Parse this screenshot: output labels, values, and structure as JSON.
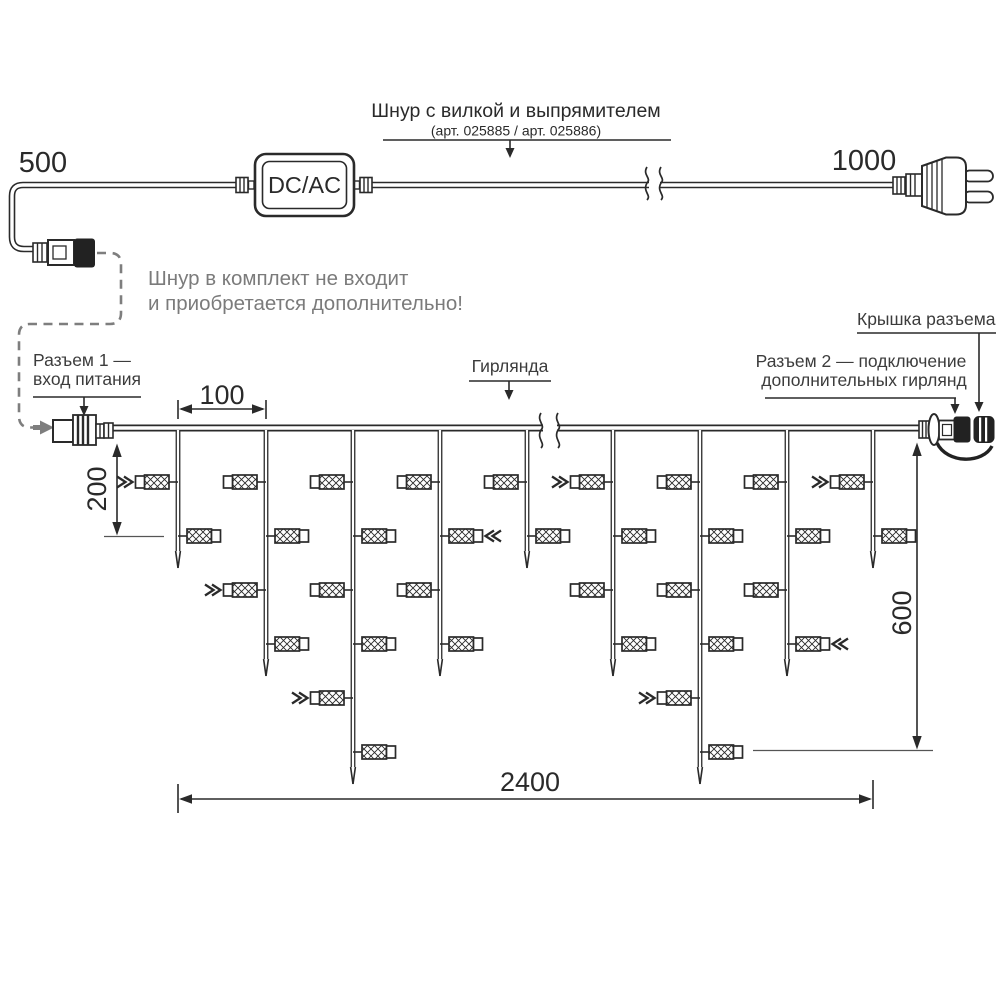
{
  "power_section": {
    "cord_label_title": "Шнур с вилкой и выпрямителем",
    "cord_label_subtitle": "(арт. 025885 / арт. 025886)",
    "converter_label": "DC/AC",
    "dim_cord_left": "500",
    "dim_cord_right": "1000",
    "note_line1": "Шнур в комплект не входит",
    "note_line2": "и приобретается дополнительно!"
  },
  "garland_section": {
    "garland_label": "Гирлянда",
    "connector1_line1": "Разъем 1 —",
    "connector1_line2": "вход питания",
    "connector2_line1": "Разъем 2 — подключение",
    "connector2_line2": "дополнительных гирлянд",
    "cap_label": "Крышка разъема",
    "dim_spacing": "100",
    "dim_first_drop": "200",
    "dim_height": "600",
    "dim_width": "2400"
  },
  "colors": {
    "line": "#2a2a2a",
    "muted": "#7b7b7b",
    "label": "#3c3c3c",
    "ref": "#555555"
  },
  "structure": {
    "wire_y": 428,
    "wire_x_start": 112,
    "wire_x_end": 921,
    "bulb_row_start_y": 482,
    "bulb_row_step": 54,
    "drop_xs": [
      178,
      266,
      353,
      440,
      527,
      613,
      700,
      787,
      873
    ],
    "drop_bulb_counts": [
      2,
      4,
      6,
      4,
      2,
      4,
      6,
      4,
      2
    ],
    "markers": [
      {
        "drop": 0,
        "row": 0,
        "dir": "right"
      },
      {
        "drop": 1,
        "row": 2,
        "dir": "right"
      },
      {
        "drop": 2,
        "row": 4,
        "dir": "right"
      },
      {
        "drop": 3,
        "row": 1,
        "dir": "left"
      },
      {
        "drop": 5,
        "row": 0,
        "dir": "right"
      },
      {
        "drop": 6,
        "row": 4,
        "dir": "right"
      },
      {
        "drop": 7,
        "row": 3,
        "dir": "left"
      },
      {
        "drop": 8,
        "row": 0,
        "dir": "right"
      }
    ]
  }
}
